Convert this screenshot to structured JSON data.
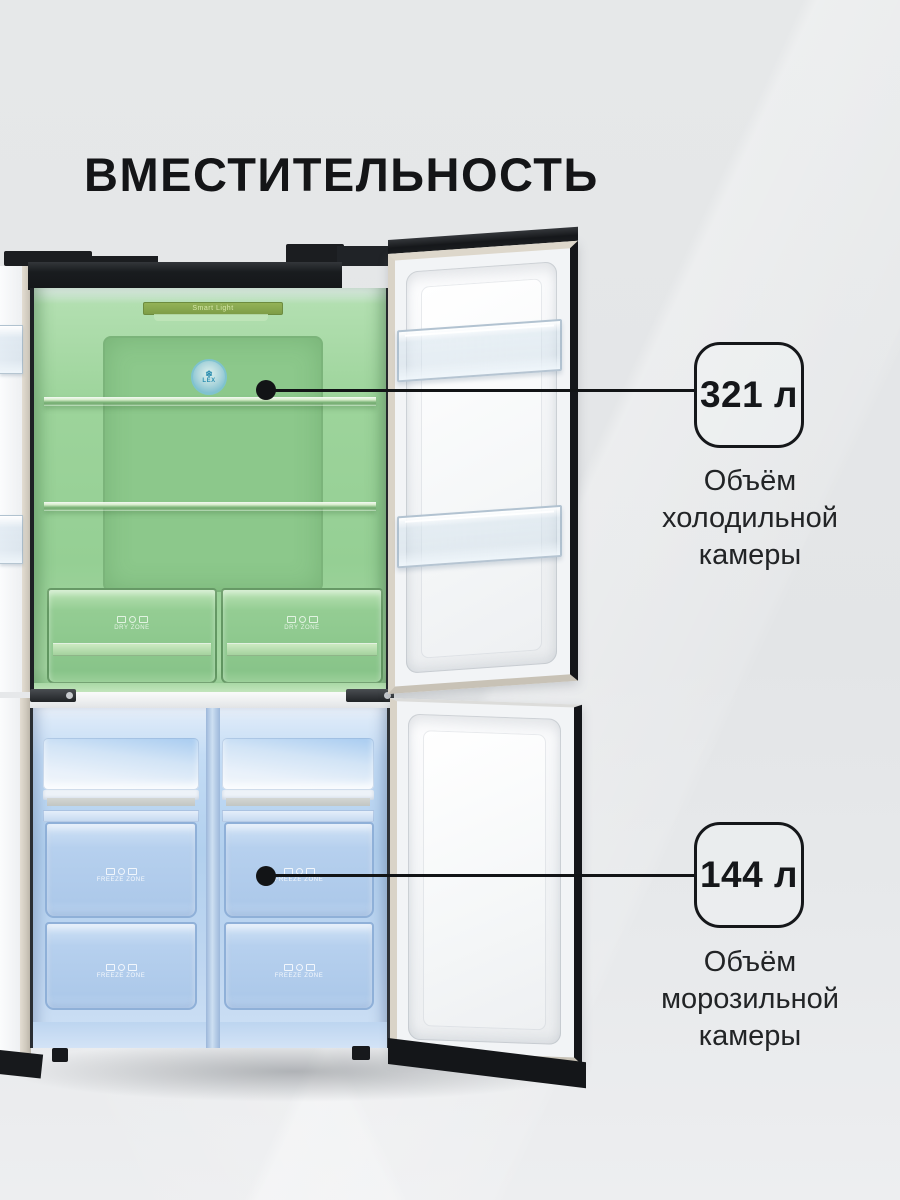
{
  "page": {
    "title": "ВМЕСТИТЕЛЬНОСТЬ"
  },
  "fridge": {
    "brand": "LEX",
    "brand_glyph": "❄",
    "smart_light_label": "Smart Light",
    "dry_zone_label": "DRY ZONE",
    "freeze_zone_label": "FREEZE ZONE"
  },
  "callouts": {
    "fridge": {
      "value": "321 л",
      "line1": "Объём",
      "line2": "холодильной",
      "line3": "камеры"
    },
    "freezer": {
      "value": "144 л",
      "line1": "Объём",
      "line2": "морозильной",
      "line3": "камеры"
    }
  },
  "colors": {
    "background": "#e4e6e8",
    "ink": "#15171a",
    "fridge_tint_green": "#9ad29a",
    "freezer_tint_blue": "#b5d1ee",
    "door_trim_beige": "#d2ccc0",
    "cabinet_black": "#17191c"
  }
}
